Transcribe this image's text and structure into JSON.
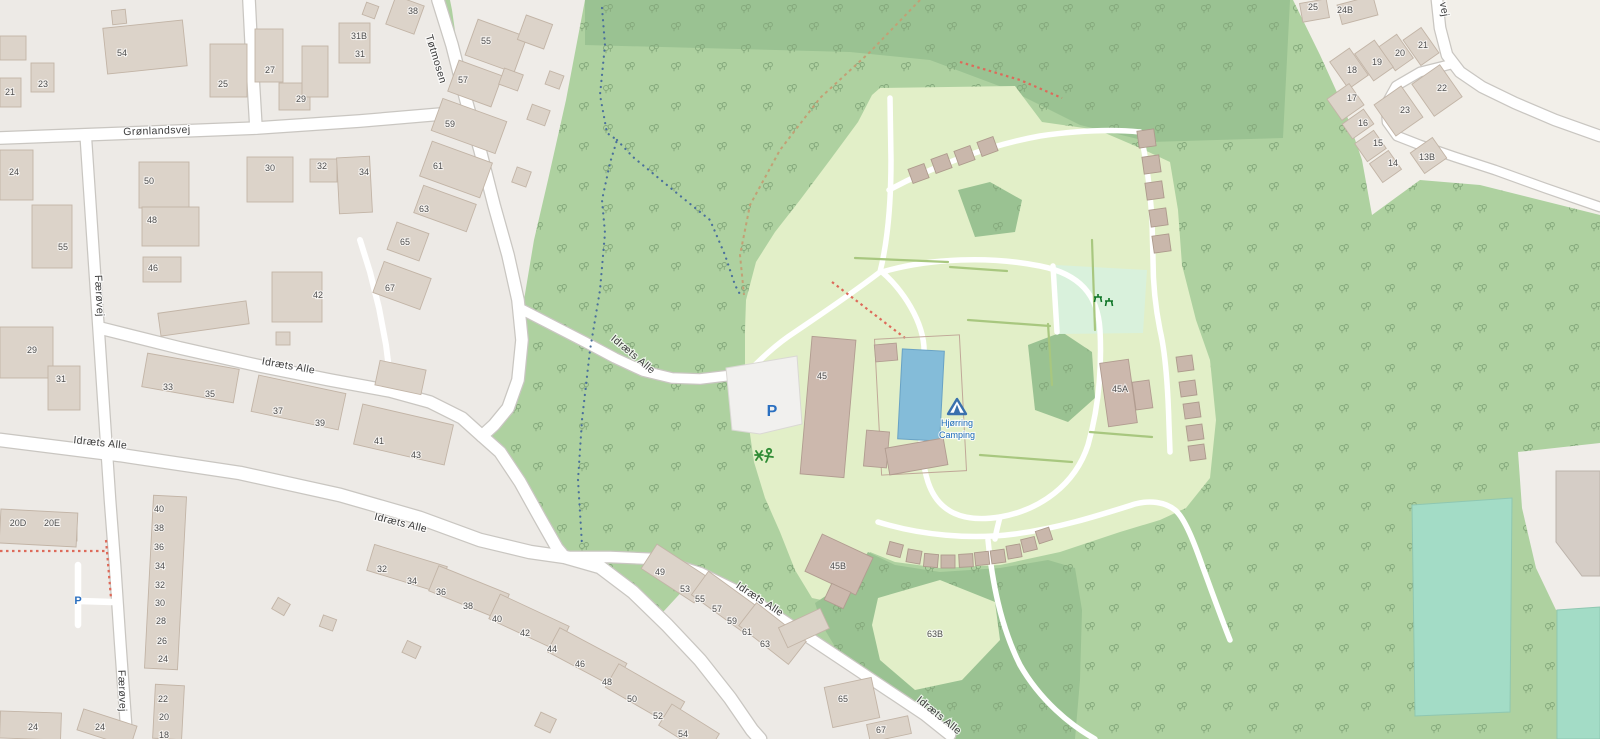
{
  "map": {
    "place": "Hjørring Camping area map",
    "colors": {
      "residential": "#edeae6",
      "residential_light": "#f2efe9",
      "forest": "#aed1a0",
      "forest_dark": "#9ac292",
      "camp": "#e2efc8",
      "picnic_mint": "#d9f1dc",
      "pitch_teal": "#a3dcc6",
      "pool_water": "#84bcd9",
      "road": "#ffffff",
      "building": "#dcd3c9",
      "building_camp": "#ccb8ad",
      "camping_label_blue": "#1a68b8",
      "parking_blue": "#2a6fc0",
      "trail_red": "#dd6a5a",
      "trail_blue": "#4a6f9b",
      "trail_tan": "#c2a075"
    },
    "poi": {
      "campsite": {
        "name_line1": "Hjørring",
        "name_line2": "Camping",
        "icon": "campsite-tent"
      },
      "parking_camp": "P",
      "parking_west": "P",
      "playground": "playground-icon",
      "picnic": "picnic-table-icon"
    },
    "labels": [
      {
        "t": "Grønlandsvej",
        "x": 157,
        "y": 134,
        "r": -2,
        "c": "s",
        "n": "street-label-gronlandsvej"
      },
      {
        "t": "Tøtmosen",
        "x": 433,
        "y": 60,
        "r": 73,
        "c": "s",
        "n": "street-label-totmosen"
      },
      {
        "t": "Færøvej",
        "x": 96,
        "y": 296,
        "r": 87,
        "c": "s",
        "n": "street-label-faerovej"
      },
      {
        "t": "Færøvej",
        "x": 119,
        "y": 691,
        "r": 88,
        "c": "s",
        "n": "street-label-faerovej"
      },
      {
        "t": "Idræts Alle",
        "x": 288,
        "y": 369,
        "r": 10,
        "c": "s",
        "n": "street-label-idraets-alle"
      },
      {
        "t": "Idræts Alle",
        "x": 100,
        "y": 446,
        "r": 6,
        "c": "s",
        "n": "street-label-idraets-alle"
      },
      {
        "t": "Idræts Alle",
        "x": 631,
        "y": 357,
        "r": 40,
        "c": "s",
        "n": "street-label-idraets-alle"
      },
      {
        "t": "Idræts Alle",
        "x": 400,
        "y": 526,
        "r": 14,
        "c": "s",
        "n": "street-label-idraets-alle"
      },
      {
        "t": "Idræts Alle",
        "x": 758,
        "y": 602,
        "r": 33,
        "c": "s",
        "n": "street-label-idraets-alle"
      },
      {
        "t": "Idræts Alle",
        "x": 937,
        "y": 718,
        "r": 39,
        "c": "s",
        "n": "street-label-idraets-alle"
      },
      {
        "t": "vej",
        "x": 1441,
        "y": 10,
        "r": 80,
        "c": "s",
        "n": "street-label-partial"
      },
      {
        "t": "Hjørring",
        "x": 957,
        "y": 426,
        "r": 0,
        "c": "cb",
        "n": "campsite-label"
      },
      {
        "t": "Camping",
        "x": 957,
        "y": 438,
        "r": 0,
        "c": "cb",
        "n": "campsite-label"
      },
      {
        "t": "P",
        "x": 772,
        "y": 416,
        "r": 0,
        "c": "pb",
        "n": "parking-icon"
      },
      {
        "t": "P",
        "x": 78,
        "y": 604,
        "r": 0,
        "c": "ps",
        "n": "parking-icon"
      },
      {
        "t": "21",
        "x": 10,
        "y": 95,
        "c": "h"
      },
      {
        "t": "23",
        "x": 43,
        "y": 87,
        "c": "h"
      },
      {
        "t": "54",
        "x": 122,
        "y": 56,
        "c": "h"
      },
      {
        "t": "25",
        "x": 223,
        "y": 87,
        "c": "h"
      },
      {
        "t": "27",
        "x": 270,
        "y": 73,
        "c": "h"
      },
      {
        "t": "29",
        "x": 301,
        "y": 102,
        "c": "h"
      },
      {
        "t": "31B",
        "x": 359,
        "y": 39,
        "c": "h"
      },
      {
        "t": "31",
        "x": 360,
        "y": 57,
        "c": "h"
      },
      {
        "t": "38",
        "x": 413,
        "y": 14,
        "c": "h"
      },
      {
        "t": "55",
        "x": 486,
        "y": 44,
        "c": "h"
      },
      {
        "t": "57",
        "x": 463,
        "y": 83,
        "c": "h"
      },
      {
        "t": "59",
        "x": 450,
        "y": 127,
        "c": "h"
      },
      {
        "t": "61",
        "x": 438,
        "y": 169,
        "c": "h"
      },
      {
        "t": "63",
        "x": 424,
        "y": 212,
        "c": "h"
      },
      {
        "t": "65",
        "x": 405,
        "y": 245,
        "c": "h"
      },
      {
        "t": "67",
        "x": 390,
        "y": 291,
        "c": "h"
      },
      {
        "t": "24",
        "x": 14,
        "y": 175,
        "c": "h"
      },
      {
        "t": "55",
        "x": 63,
        "y": 250,
        "c": "h"
      },
      {
        "t": "50",
        "x": 149,
        "y": 184,
        "c": "h"
      },
      {
        "t": "48",
        "x": 152,
        "y": 223,
        "c": "h"
      },
      {
        "t": "46",
        "x": 153,
        "y": 271,
        "c": "h"
      },
      {
        "t": "30",
        "x": 270,
        "y": 171,
        "c": "h"
      },
      {
        "t": "32",
        "x": 322,
        "y": 169,
        "c": "h"
      },
      {
        "t": "34",
        "x": 364,
        "y": 175,
        "c": "h"
      },
      {
        "t": "42",
        "x": 318,
        "y": 298,
        "c": "h"
      },
      {
        "t": "29",
        "x": 32,
        "y": 353,
        "c": "h"
      },
      {
        "t": "31",
        "x": 61,
        "y": 382,
        "c": "h"
      },
      {
        "t": "33",
        "x": 168,
        "y": 390,
        "c": "h"
      },
      {
        "t": "35",
        "x": 210,
        "y": 397,
        "c": "h"
      },
      {
        "t": "37",
        "x": 278,
        "y": 414,
        "c": "h"
      },
      {
        "t": "39",
        "x": 320,
        "y": 426,
        "c": "h"
      },
      {
        "t": "41",
        "x": 379,
        "y": 444,
        "c": "h"
      },
      {
        "t": "43",
        "x": 416,
        "y": 458,
        "c": "h"
      },
      {
        "t": "20D",
        "x": 18,
        "y": 526,
        "c": "h"
      },
      {
        "t": "20E",
        "x": 52,
        "y": 526,
        "c": "h"
      },
      {
        "t": "40",
        "x": 159,
        "y": 512,
        "c": "h"
      },
      {
        "t": "38",
        "x": 159,
        "y": 531,
        "c": "h"
      },
      {
        "t": "36",
        "x": 159,
        "y": 550,
        "c": "h"
      },
      {
        "t": "34",
        "x": 160,
        "y": 569,
        "c": "h"
      },
      {
        "t": "32",
        "x": 160,
        "y": 588,
        "c": "h"
      },
      {
        "t": "30",
        "x": 160,
        "y": 606,
        "c": "h"
      },
      {
        "t": "28",
        "x": 161,
        "y": 624,
        "c": "h"
      },
      {
        "t": "26",
        "x": 162,
        "y": 644,
        "c": "h"
      },
      {
        "t": "24",
        "x": 163,
        "y": 662,
        "c": "h"
      },
      {
        "t": "22",
        "x": 163,
        "y": 702,
        "c": "h"
      },
      {
        "t": "20",
        "x": 164,
        "y": 720,
        "c": "h"
      },
      {
        "t": "18",
        "x": 164,
        "y": 738,
        "c": "h"
      },
      {
        "t": "24",
        "x": 33,
        "y": 730,
        "c": "h"
      },
      {
        "t": "24",
        "x": 100,
        "y": 730,
        "c": "h"
      },
      {
        "t": "32",
        "x": 382,
        "y": 572,
        "c": "h"
      },
      {
        "t": "34",
        "x": 412,
        "y": 584,
        "c": "h"
      },
      {
        "t": "36",
        "x": 441,
        "y": 595,
        "c": "h"
      },
      {
        "t": "38",
        "x": 468,
        "y": 609,
        "c": "h"
      },
      {
        "t": "40",
        "x": 497,
        "y": 622,
        "c": "h"
      },
      {
        "t": "42",
        "x": 525,
        "y": 636,
        "c": "h"
      },
      {
        "t": "44",
        "x": 552,
        "y": 652,
        "c": "h"
      },
      {
        "t": "46",
        "x": 580,
        "y": 667,
        "c": "h"
      },
      {
        "t": "48",
        "x": 607,
        "y": 685,
        "c": "h"
      },
      {
        "t": "50",
        "x": 632,
        "y": 702,
        "c": "h"
      },
      {
        "t": "52",
        "x": 658,
        "y": 719,
        "c": "h"
      },
      {
        "t": "54",
        "x": 683,
        "y": 737,
        "c": "h"
      },
      {
        "t": "49",
        "x": 660,
        "y": 575,
        "c": "h"
      },
      {
        "t": "53",
        "x": 685,
        "y": 592,
        "c": "h"
      },
      {
        "t": "55",
        "x": 700,
        "y": 602,
        "c": "h"
      },
      {
        "t": "57",
        "x": 717,
        "y": 612,
        "c": "h"
      },
      {
        "t": "59",
        "x": 732,
        "y": 624,
        "c": "h"
      },
      {
        "t": "61",
        "x": 747,
        "y": 635,
        "c": "h"
      },
      {
        "t": "63",
        "x": 765,
        "y": 647,
        "c": "h"
      },
      {
        "t": "65",
        "x": 843,
        "y": 702,
        "c": "h"
      },
      {
        "t": "67",
        "x": 881,
        "y": 733,
        "c": "h"
      },
      {
        "t": "45",
        "x": 822,
        "y": 379,
        "c": "h"
      },
      {
        "t": "45A",
        "x": 1120,
        "y": 392,
        "c": "h"
      },
      {
        "t": "45B",
        "x": 838,
        "y": 569,
        "c": "h"
      },
      {
        "t": "63B",
        "x": 935,
        "y": 637,
        "c": "h"
      },
      {
        "t": "25",
        "x": 1313,
        "y": 10,
        "c": "h"
      },
      {
        "t": "24B",
        "x": 1345,
        "y": 13,
        "c": "h"
      },
      {
        "t": "21",
        "x": 1423,
        "y": 48,
        "c": "h"
      },
      {
        "t": "20",
        "x": 1400,
        "y": 56,
        "c": "h"
      },
      {
        "t": "19",
        "x": 1377,
        "y": 65,
        "c": "h"
      },
      {
        "t": "18",
        "x": 1352,
        "y": 73,
        "c": "h"
      },
      {
        "t": "22",
        "x": 1442,
        "y": 91,
        "c": "h"
      },
      {
        "t": "23",
        "x": 1405,
        "y": 113,
        "c": "h"
      },
      {
        "t": "17",
        "x": 1352,
        "y": 101,
        "c": "h"
      },
      {
        "t": "16",
        "x": 1363,
        "y": 126,
        "c": "h"
      },
      {
        "t": "15",
        "x": 1378,
        "y": 146,
        "c": "h"
      },
      {
        "t": "14",
        "x": 1393,
        "y": 166,
        "c": "h"
      },
      {
        "t": "13B",
        "x": 1427,
        "y": 160,
        "c": "h"
      }
    ]
  }
}
